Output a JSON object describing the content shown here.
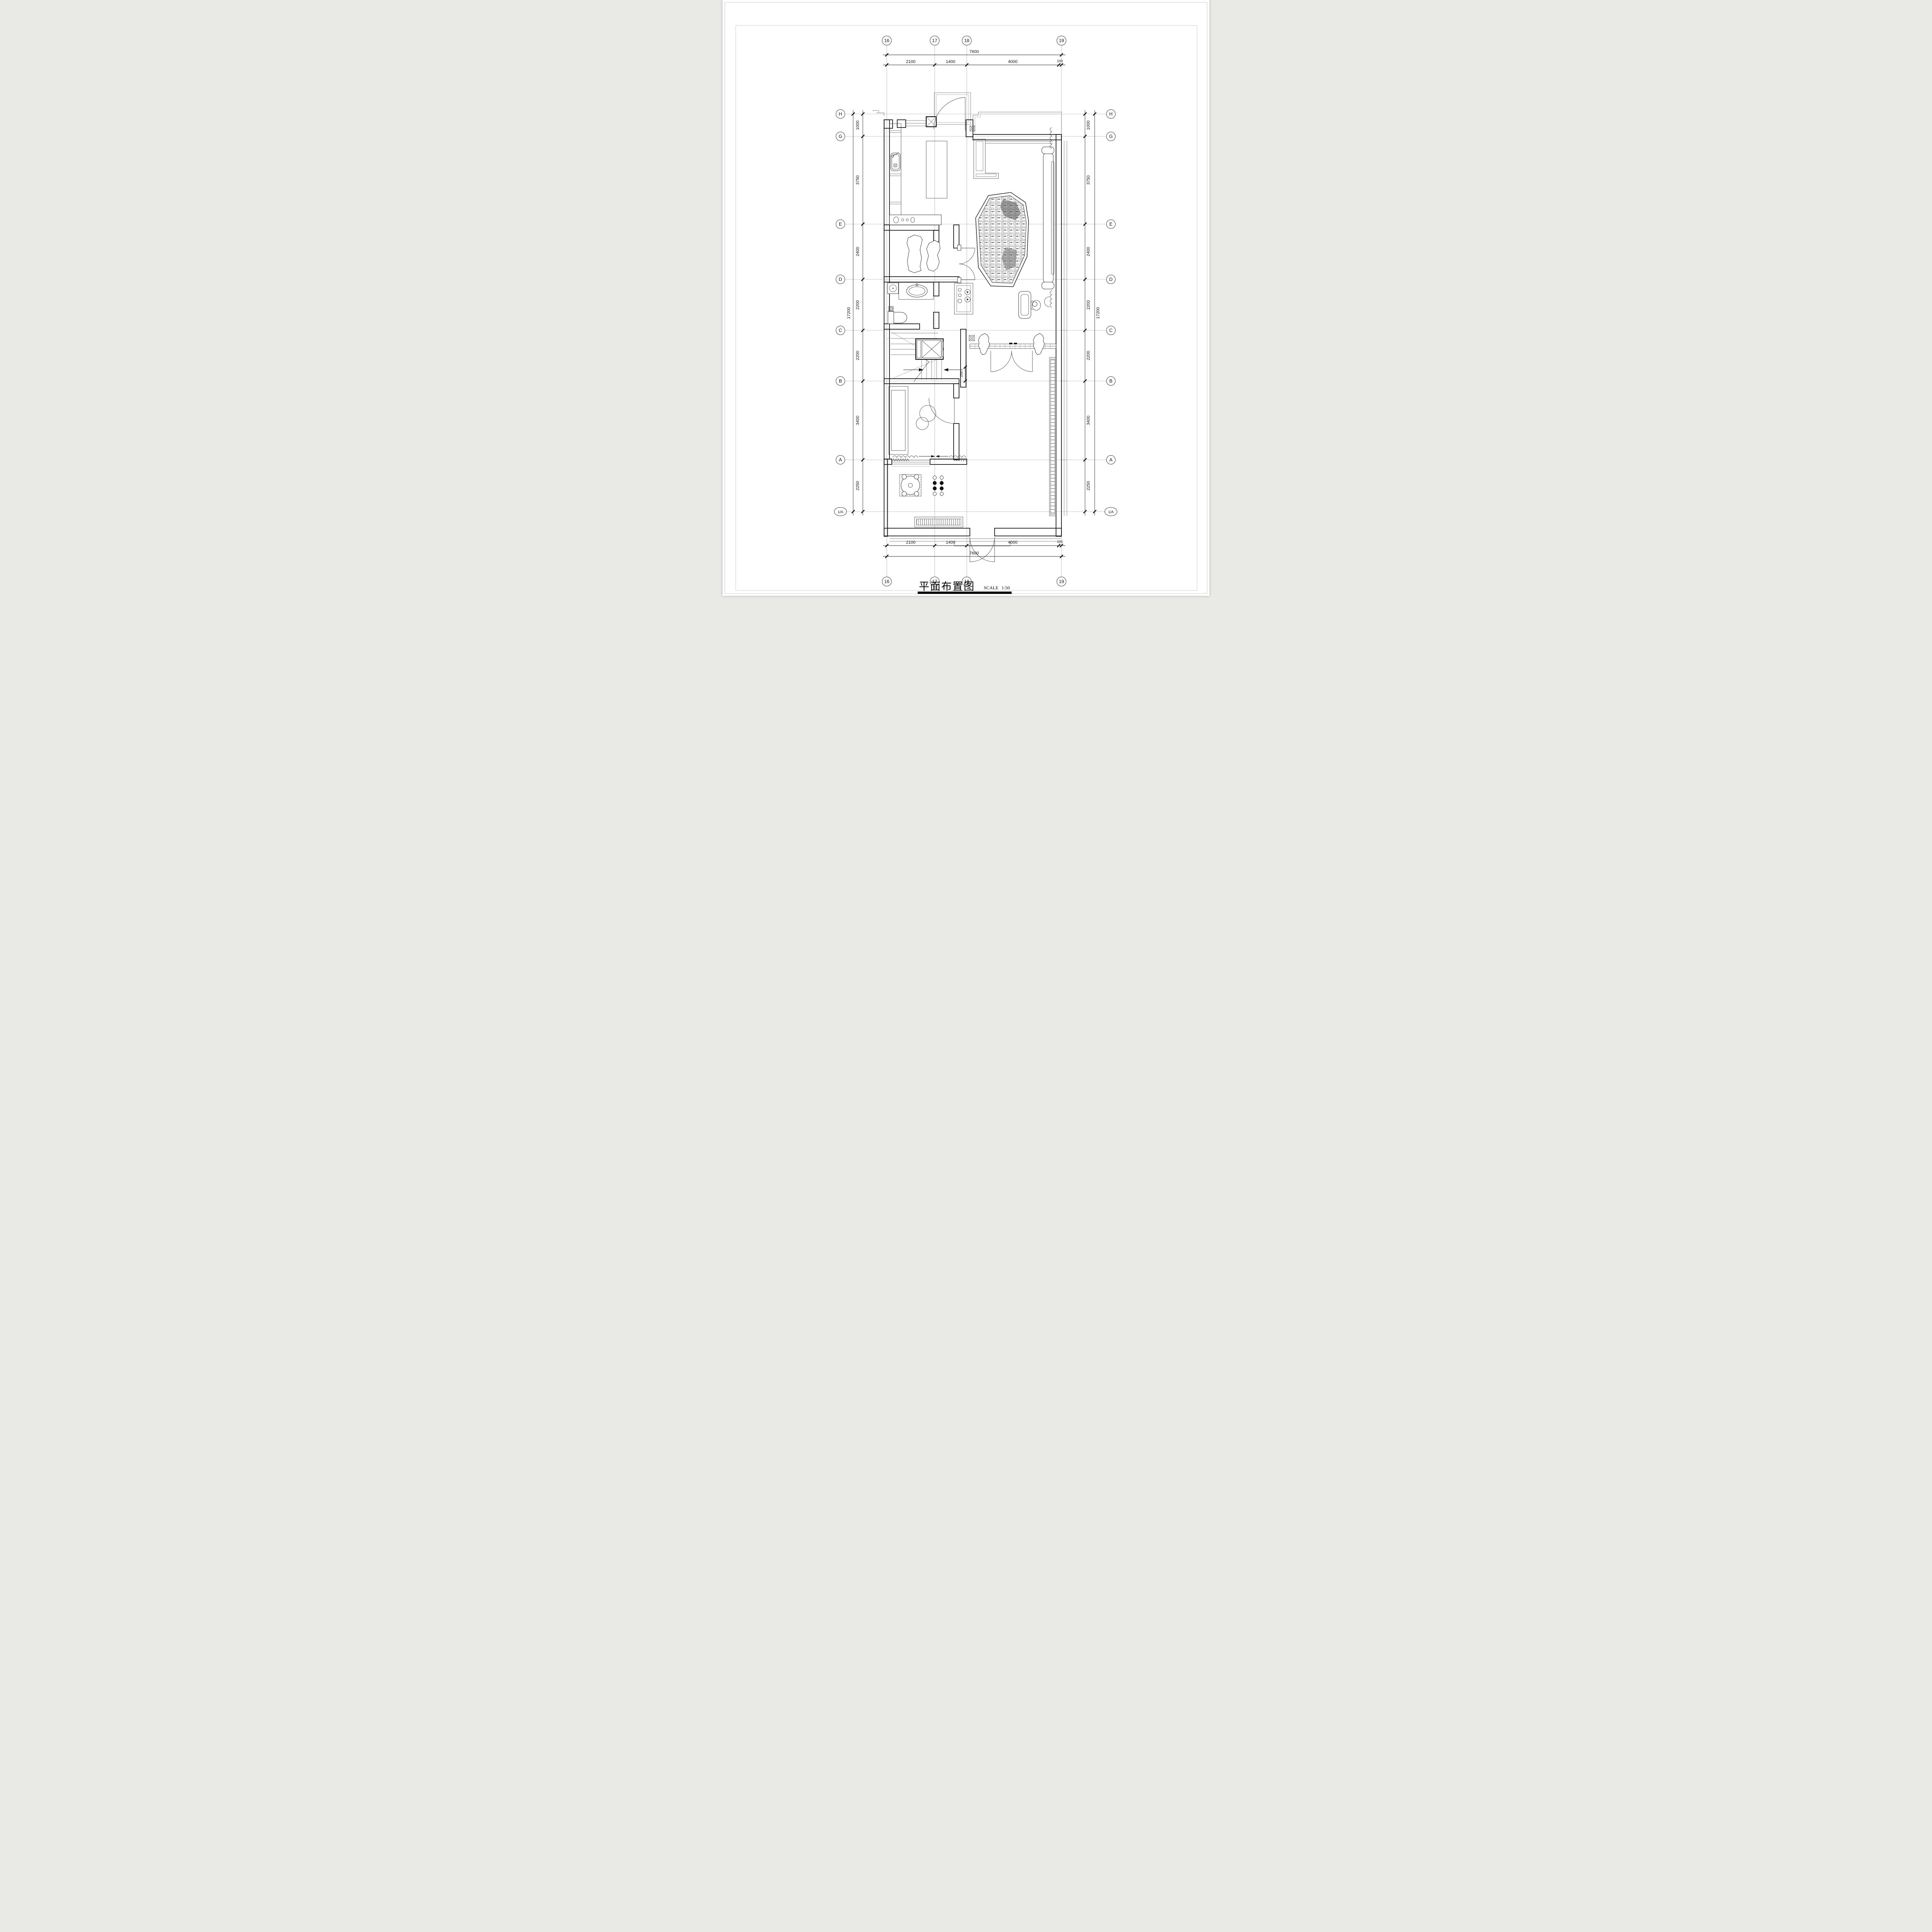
{
  "sheet": {
    "title": "平面布置图",
    "scale_label": "SCALE",
    "scale_value": "1:50"
  },
  "grid": {
    "cols": [
      "16",
      "17",
      "18",
      "19"
    ],
    "rows": [
      "H",
      "G",
      "E",
      "D",
      "C",
      "B",
      "A",
      "1/A"
    ],
    "dims": {
      "top_total": "7600",
      "bottom_total": "7600",
      "seg_2100": "2100",
      "seg_1400": "1400",
      "seg_4000": "4000",
      "seg_100": "100",
      "left_total": "17200",
      "right_total": "17200",
      "seg_1000": "1000",
      "seg_3750": "3750",
      "seg_2400": "2400",
      "seg_2200a": "2200",
      "seg_2200b": "2200",
      "seg_3400": "3400",
      "seg_2250": "2250",
      "stair_break": "200"
    }
  }
}
